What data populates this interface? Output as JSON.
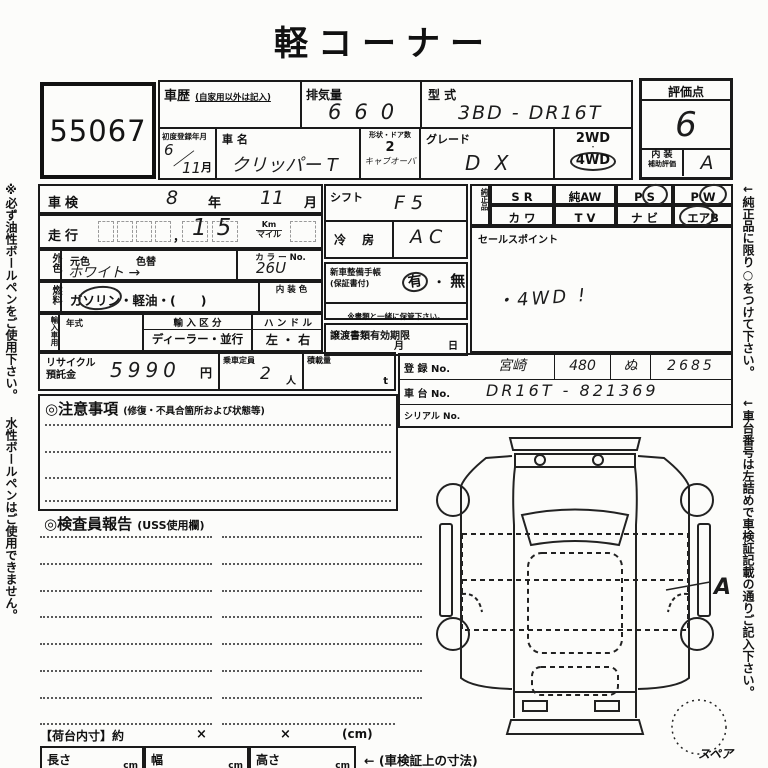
{
  "title": "軽コーナー",
  "side_notes": {
    "left_1": "※必ず油性ボールペンをご使用下さい。",
    "left_2": "水性ボールペンはご使用できません。",
    "right_1": "←純正品に限り○をつけて下さい。",
    "right_2": "←車台番号は左詰めで車検証記載の通りご記入下さい。"
  },
  "lot_number": "55067",
  "header": {
    "history_label": "車歴",
    "history_note": "(自家用以外は記入)",
    "displacement_label": "排気量",
    "displacement_value": "660",
    "model_label": "型 式",
    "model_value": "3BD - DR16T",
    "first_reg_label": "初度登録年月",
    "first_reg_year": "6",
    "first_reg_month": "11",
    "month_unit": "月",
    "name_label": "車 名",
    "name_value": "クリッパー T",
    "shape_label": "形状・ドア数",
    "doors_value": "2",
    "body_type_value": "キャブオーバ",
    "grade_label": "グレード",
    "grade_value": "D X",
    "wd2_label": "2WD",
    "wd4_label": "4WD"
  },
  "score": {
    "label": "評価点",
    "value": "6",
    "interior_label": "内 装",
    "interior_sub_label": "補助評価",
    "interior_value": "A"
  },
  "inspection": {
    "shaken_label": "車検",
    "shaken_year": "8",
    "year_unit": "年",
    "shaken_month": "11",
    "month_unit": "月",
    "mileage_label": "走行",
    "mileage_comma": "，",
    "mileage_value": "15",
    "unit_km": "Km",
    "unit_mile": "マイル",
    "ext_color_label": "外色",
    "orig_color_label": "元色",
    "recolor_label": "色替",
    "color_value": "ホワイト →",
    "color_no_label": "カ ラ ー No.",
    "color_no_value": "26U",
    "fuel_label": "燃料",
    "fuel_options": "ガソリン・軽油・(　　)",
    "interior_color_label": "内 装 色",
    "import_label": "輸入車用",
    "year_label": "年式",
    "import_class_label": "輸 入 区 分",
    "import_class_options": "ディーラー・並行",
    "handle_label": "ハ ン ド ル",
    "handle_options": "左 ・ 右",
    "recycle_label_1": "リサイクル",
    "recycle_label_2": "預託金",
    "recycle_value": "5990",
    "yen_unit": "円",
    "capacity_label": "乗車定員",
    "capacity_value": "2",
    "person_unit": "人",
    "load_label": "積載量",
    "load_unit": "t"
  },
  "middle": {
    "shift_label": "シフト",
    "shift_value": "F 5",
    "ac_label": "冷 房",
    "ac_value": "A C",
    "booklet_label": "新車整備手帳",
    "booklet_sub": "(保証書付)",
    "booklet_yes": "有",
    "booklet_sep": "・",
    "booklet_no": "無",
    "booklet_note": "※書類と一緒に保管下さい。",
    "transfer_label": "譲渡書類有効期限",
    "transfer_month": "月",
    "transfer_day": "日"
  },
  "equipment": {
    "label": "純正品",
    "row1": [
      "S R",
      "純AW",
      "P S",
      "P W"
    ],
    "row2": [
      "カ ワ",
      "T V",
      "ナ ビ",
      "エアB"
    ],
    "circled_items": "P S, P W, エアB"
  },
  "sales": {
    "label": "セールスポイント",
    "value": "・4WD !"
  },
  "registration": {
    "reg_label": "登 録 No.",
    "reg_area": "宮崎",
    "reg_class": "480",
    "reg_kana": "ぬ",
    "reg_number": "2685",
    "chassis_label": "車 台 No.",
    "chassis_value": "DR16T - 821369",
    "serial_label": "シリアル No."
  },
  "notes_section": {
    "title": "◎注意事項",
    "subtitle": "(修復・不具合箇所および状態等)"
  },
  "inspector_section": {
    "title": "◎検査員報告",
    "subtitle": "(USS使用欄)"
  },
  "diagram": {
    "annotation": "A",
    "spare_label": "スペア"
  },
  "footer": {
    "bed_label": "【荷台内寸】約",
    "times_1": "×",
    "times_2": "×",
    "cm_note": "(cm)",
    "length_label": "長さ",
    "width_label": "幅",
    "height_label": "高さ",
    "cm_unit": "cm",
    "dims_note": "← (車検証上の寸法)"
  }
}
